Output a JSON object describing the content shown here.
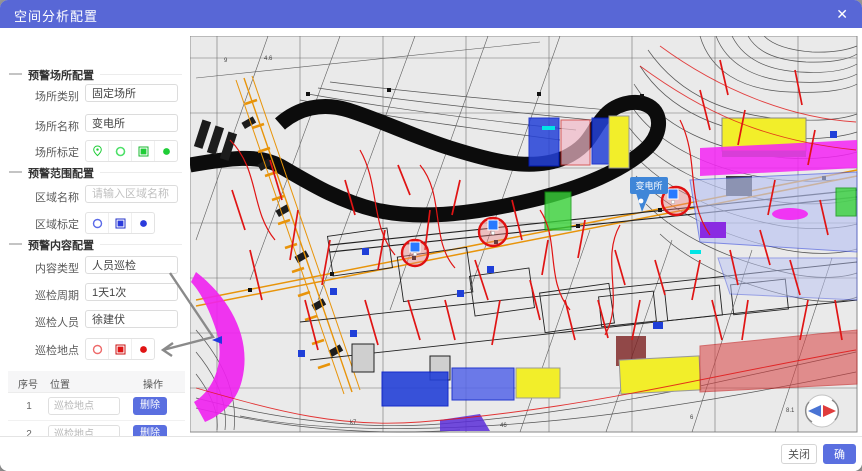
{
  "header": {
    "title": "空间分析配置",
    "close_icon": "✕"
  },
  "sections": {
    "place": "预警场所配置",
    "range": "预警范围配置",
    "content": "预警内容配置"
  },
  "form": {
    "place_category": {
      "label": "场所类别",
      "value": "固定场所"
    },
    "place_name": {
      "label": "场所名称",
      "value": "变电所"
    },
    "place_mark": {
      "label": "场所标定"
    },
    "area_name": {
      "label": "区域名称",
      "placeholder": "请输入区域名称"
    },
    "area_mark": {
      "label": "区域标定"
    },
    "content_type": {
      "label": "内容类型",
      "value": "人员巡检"
    },
    "patrol_cycle": {
      "label": "巡检周期",
      "value": "1天1次"
    },
    "patrol_person": {
      "label": "巡检人员",
      "value": "徐建伏"
    },
    "patrol_point": {
      "label": "巡检地点"
    }
  },
  "table": {
    "headers": {
      "no": "序号",
      "position": "位置",
      "action": "操作"
    },
    "rows": [
      {
        "no": "1",
        "position": "巡检地点",
        "action": "删除"
      },
      {
        "no": "2",
        "position": "巡检地点",
        "action": "删除"
      },
      {
        "no": "3",
        "position": "巡检地点",
        "action": "删除"
      }
    ]
  },
  "footer": {
    "close": "关闭",
    "confirm": "确定"
  },
  "map": {
    "pin_label": "变电所",
    "labels": [
      "4.6",
      "k7",
      "46",
      "6",
      "8.1",
      "9"
    ]
  },
  "colors": {
    "accent": "#5867d6",
    "button_blue": "#5a6fe0",
    "mark_green": "#1fcd37",
    "mark_blue": "#2b3bdc",
    "mark_red": "#e01414",
    "pin_blue": "#3f86d8",
    "circle_red": "#e01010"
  }
}
